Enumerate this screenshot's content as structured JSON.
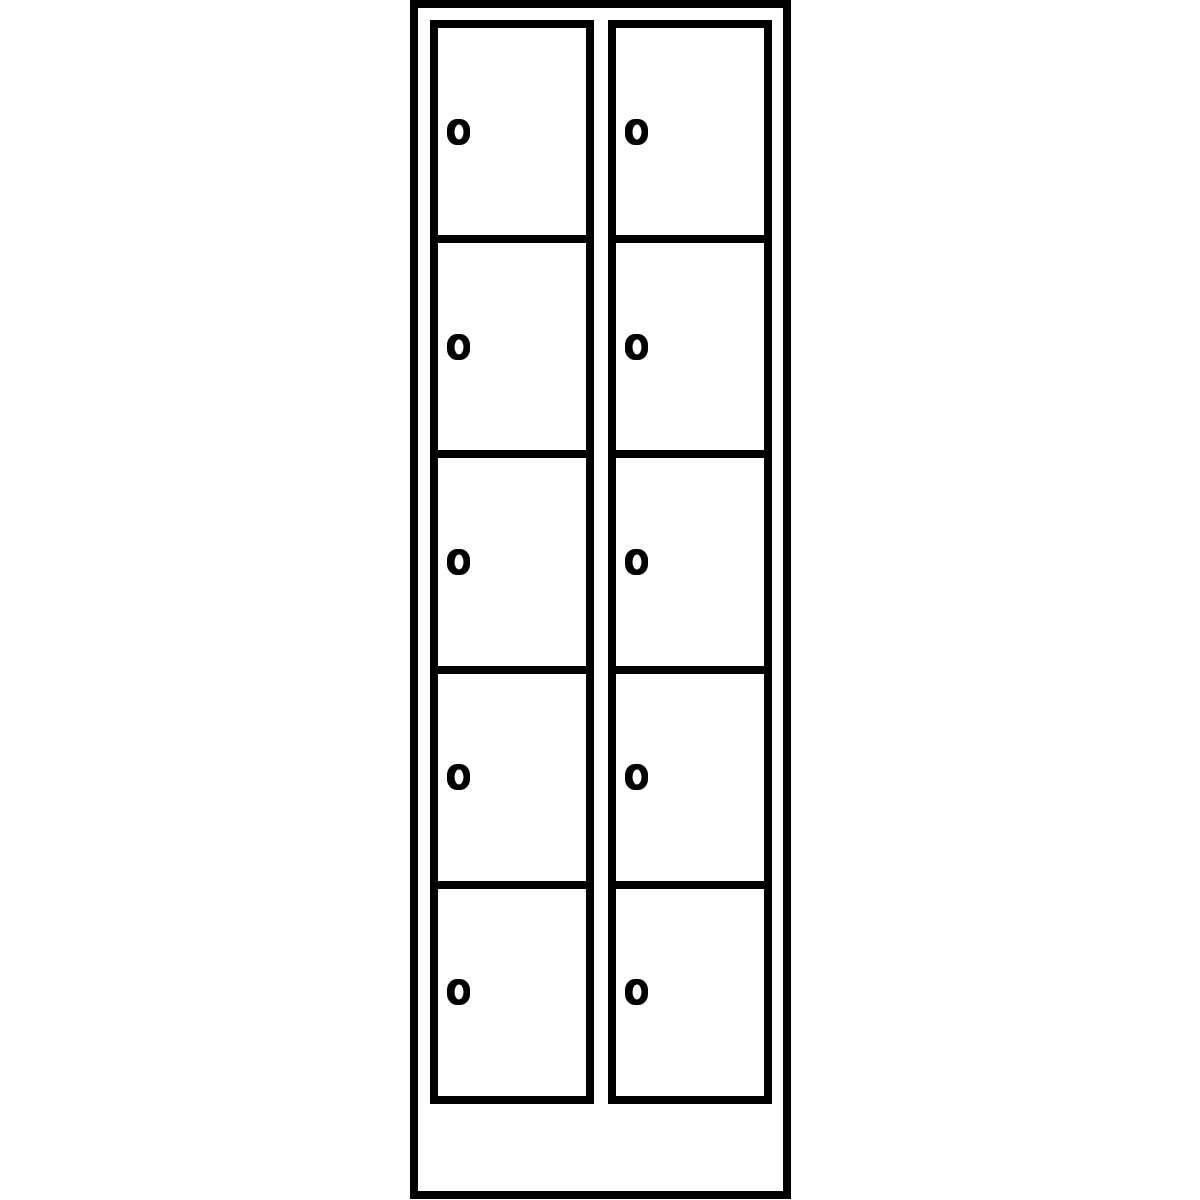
{
  "diagram": {
    "type": "locker-cabinet-line-drawing",
    "columns": 2,
    "rows_per_column": 5,
    "total_compartments": 10,
    "column_names": [
      "left",
      "right"
    ],
    "lock_icon": "cylinder-lock-icon",
    "lock_per_door": 1,
    "has_plinth": true,
    "visible_text": ""
  },
  "colors": {
    "line": "#000000",
    "fill": "#ffffff",
    "background": "#ffffff"
  }
}
